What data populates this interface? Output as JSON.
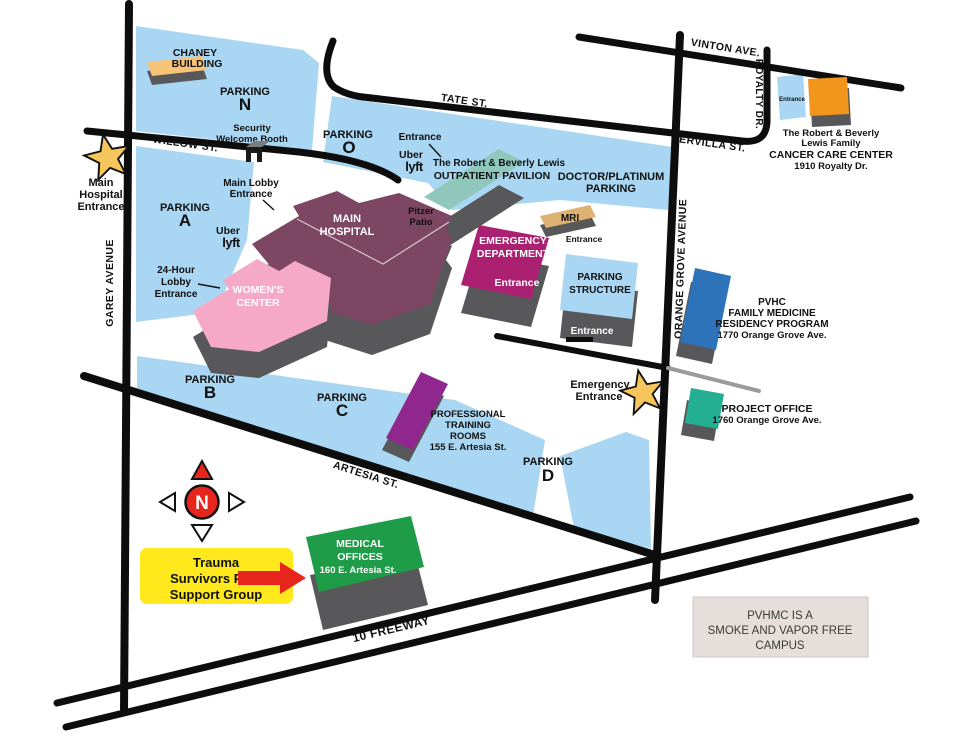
{
  "colors": {
    "lot_blue": "#A9D6F2",
    "road": "#0D0D0D",
    "gray_road": "#9B9B9B",
    "side_gray": "#58585B",
    "chaney": "#F6C377",
    "pavilion": "#8FC7BC",
    "hospital": "#7D4663",
    "emergency": "#AC2071",
    "womens": "#F5A9C7",
    "mri": "#DDB273",
    "structure": "#A9D6F2",
    "pvhc": "#2C73B9",
    "project": "#24AE94",
    "training": "#90278E",
    "medical": "#1F9C47",
    "cancer": "#F2951D",
    "star": "#F6C65C",
    "red": "#E8251D",
    "callout_bg": "#FFE81C",
    "notice_bg": "#E5DEDB"
  },
  "streets": {
    "garey": "GAREY AVENUE",
    "willow": "WILLOW ST.",
    "tate": "TATE ST.",
    "vinton": "VINTON AVE.",
    "royalty": "ROYALTY DR.",
    "ervilla": "ERVILLA ST.",
    "orange_grove": "ORANGE GROVE AVENUE",
    "artesia": "ARTESIA ST.",
    "freeway": "10 FREEWAY"
  },
  "parking": {
    "word": "PARKING",
    "n": "N",
    "o": "O",
    "a": "A",
    "b": "B",
    "c": "C",
    "d": "D",
    "structure": [
      "PARKING",
      "STRUCTURE"
    ],
    "doctor": [
      "DOCTOR/PLATINUM",
      "PARKING"
    ]
  },
  "buildings": {
    "chaney": [
      "CHANEY",
      "BUILDING"
    ],
    "pavilion": [
      "The Robert & Beverly Lewis",
      "OUTPATIENT PAVILION"
    ],
    "hospital": [
      "MAIN",
      "HOSPITAL"
    ],
    "womens": [
      "WOMEN'S",
      "CENTER"
    ],
    "emergency": [
      "EMERGENCY",
      "DEPARTMENT"
    ],
    "mri": "MRI",
    "pvhc": [
      "PVHC",
      "FAMILY MEDICINE",
      "RESIDENCY PROGRAM",
      "1770 Orange Grove Ave."
    ],
    "project": [
      "PROJECT OFFICE",
      "1760 Orange Grove Ave."
    ],
    "training": [
      "PROFESSIONAL",
      "TRAINING",
      "ROOMS",
      "155 E. Artesia St."
    ],
    "medical": [
      "MEDICAL",
      "OFFICES",
      "160 E. Artesia St."
    ],
    "cancer": [
      "The Robert & Beverly",
      "Lewis Family",
      "CANCER CARE CENTER",
      "1910 Royalty Dr."
    ]
  },
  "annotations": {
    "entrance": "Entrance",
    "security": [
      "Security",
      "Welcome Booth"
    ],
    "main_lobby": [
      "Main Lobby",
      "Entrance"
    ],
    "lobby24": [
      "24-Hour",
      "Lobby",
      "Entrance"
    ],
    "pitzer": [
      "Pitzer",
      "Patio"
    ],
    "main_entrance": [
      "Main",
      "Hospital",
      "Entrance"
    ],
    "emergency_entrance": [
      "Emergency",
      "Entrance"
    ],
    "uber": "Uber",
    "lyft": "lyft",
    "north": "N",
    "callout": [
      "Trauma",
      "Survivors Peer",
      "Support Group"
    ],
    "notice": [
      "PVHMC IS A",
      "SMOKE AND VAPOR FREE",
      "CAMPUS"
    ]
  }
}
